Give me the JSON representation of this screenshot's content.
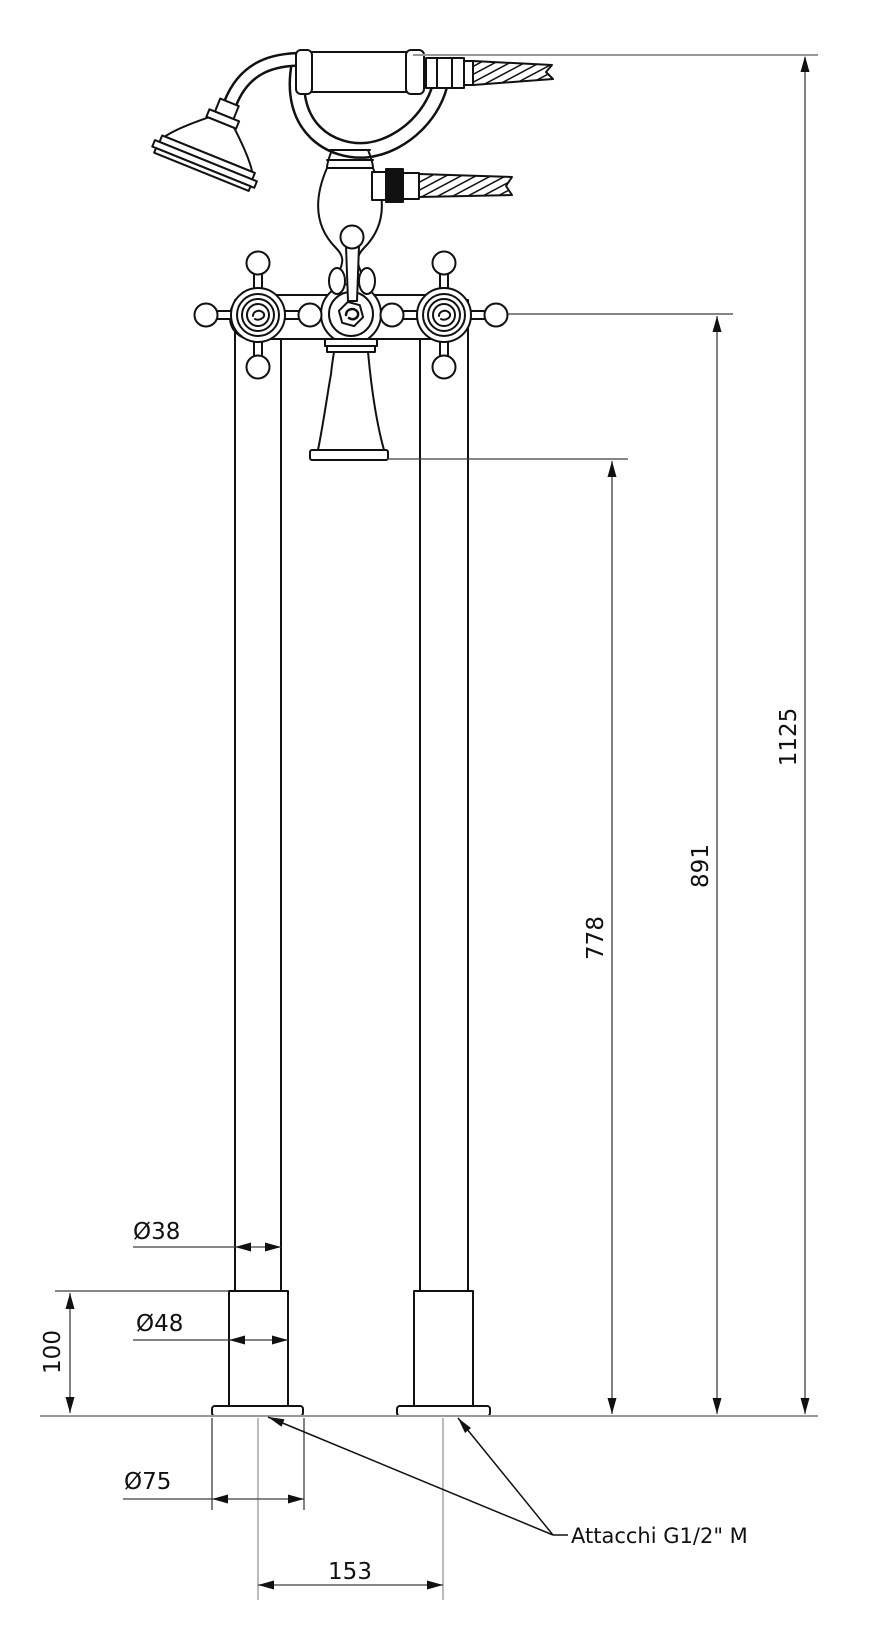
{
  "drawing": {
    "dimensions": {
      "overall_height": "1125",
      "handle_height": "891",
      "spout_height": "778",
      "pipe_diameter": "Ø38",
      "base_diameter": "Ø48",
      "base_height": "100",
      "flange_diameter": "Ø75",
      "pipe_center_distance": "153"
    },
    "annotations": {
      "connections_label": "Attacchi G1/2\" M"
    },
    "colors": {
      "object_line": "#111111",
      "dimension_line": "#3f3f3f",
      "reference_line": "#999999",
      "text": "#111111",
      "background": "#ffffff"
    }
  }
}
